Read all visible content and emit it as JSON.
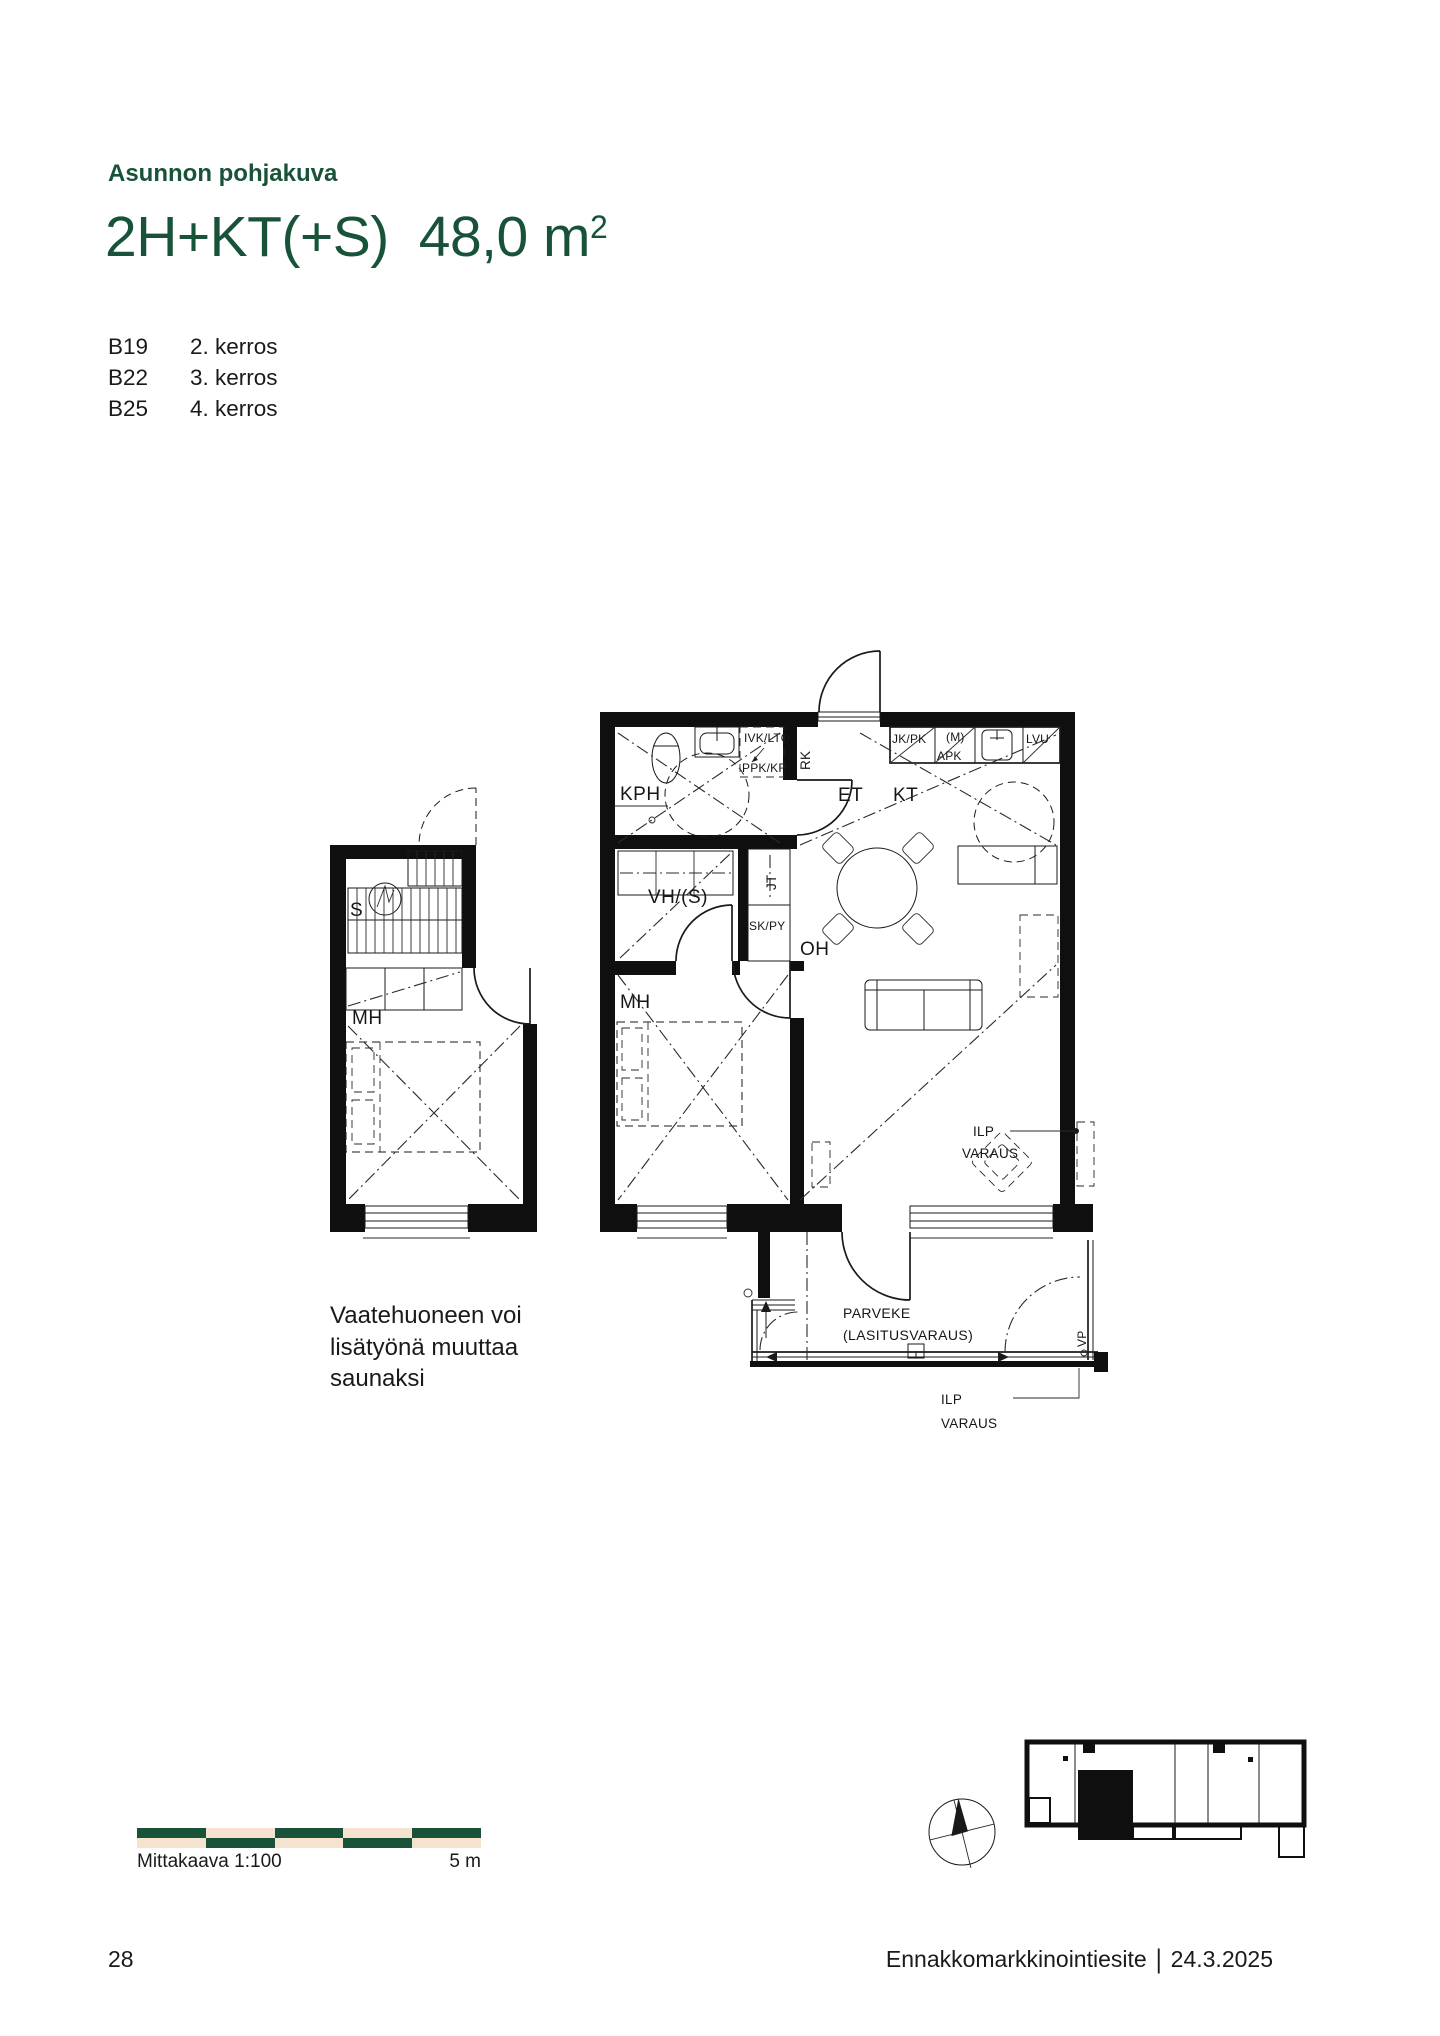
{
  "colors": {
    "green": "#185339",
    "beige": "#f6e3cf",
    "ink": "#1a1a1a"
  },
  "header": {
    "eyebrow": "Asunnon pohjakuva",
    "title": "2H+KT(+S)",
    "area": "48,0 m",
    "area_exponent": "2"
  },
  "units": [
    {
      "code": "B19",
      "floor": "2. kerros"
    },
    {
      "code": "B22",
      "floor": "3. kerros"
    },
    {
      "code": "B25",
      "floor": "4. kerros"
    }
  ],
  "note": {
    "line1": "Vaatehuoneen voi",
    "line2": "lisätyönä muuttaa",
    "line3": "saunaksi"
  },
  "plan": {
    "kph": "KPH",
    "ivk_lto": "IVK/LTO",
    "ppk_kr": "PPK/KR",
    "rk": "RK",
    "et": "ET",
    "kt": "KT",
    "jk_pk": "JK/PK",
    "m": "(M)",
    "apk": "APK",
    "lvu": "LVU",
    "vh_s": "VH/(S)",
    "jt": "JT",
    "sk_py": "SK/PY",
    "mh": "MH",
    "oh": "OH",
    "ilp": "ILP",
    "varaus": "VARAUS",
    "parveke": "PARVEKE",
    "lasitusvaraus": "(LASITUSVARAUS)",
    "vp": "VP",
    "s": "S",
    "mh_variant": "MH"
  },
  "scalebar": {
    "label": "Mittakaava 1:100",
    "max": "5 m"
  },
  "footer": {
    "page": "28",
    "document": "Ennakkomarkkinointiesite",
    "separator": "|",
    "date": "24.3.2025"
  }
}
